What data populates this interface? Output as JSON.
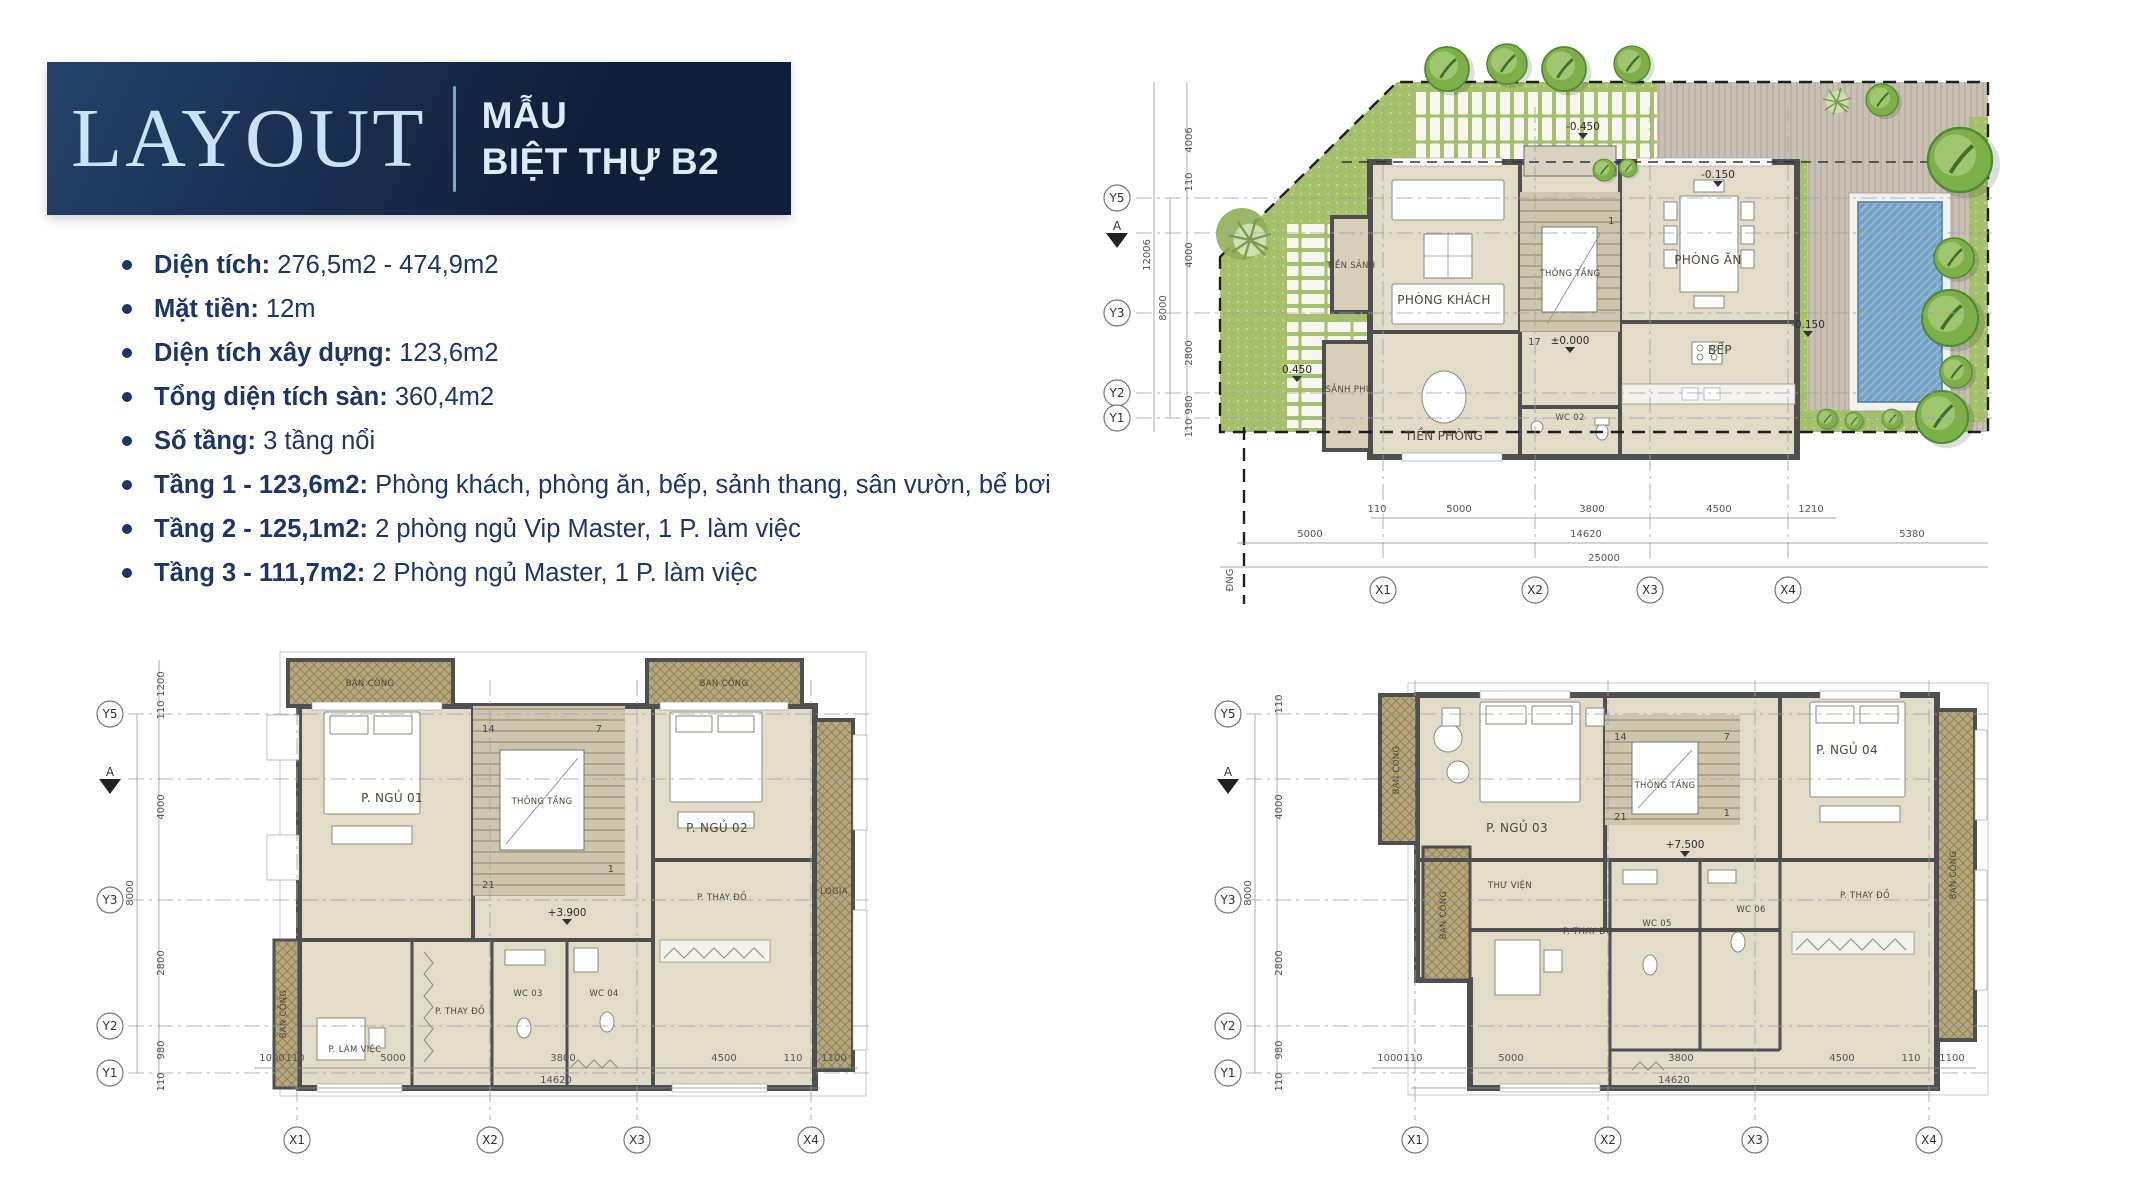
{
  "header": {
    "title": "LAYOUT",
    "subtitle_line1": "MẪU",
    "subtitle_line2": "BIỆT THỰ B2"
  },
  "specs": [
    {
      "label": "Diện tích:",
      "value": "276,5m2 - 474,9m2"
    },
    {
      "label": "Mặt tiền:",
      "value": "12m"
    },
    {
      "label": "Diện tích xây dựng:",
      "value": "123,6m2"
    },
    {
      "label": "Tổng diện tích sàn:",
      "value": "360,4m2"
    },
    {
      "label": "Số tầng:",
      "value": "3 tầng nổi"
    },
    {
      "label": "Tầng 1 - 123,6m2:",
      "value": "Phòng khách, phòng ăn, bếp, sảnh thang, sân vườn, bể bơi"
    },
    {
      "label": "Tầng 2 - 125,1m2:",
      "value": "2 phòng ngủ Vip Master, 1 P. làm việc"
    },
    {
      "label": "Tầng 3 - 111,7m2:",
      "value": "2 Phòng ngủ Master, 1 P. làm việc"
    }
  ],
  "site_plan": {
    "rooms": {
      "tien_sanh": "TIỀN SẢNH",
      "phong_khach": "PHÒNG KHÁCH",
      "thong_tang": "THÔNG TẦNG",
      "phong_an": "PHÒNG ĂN",
      "bep": "BẾP",
      "wc02": "WC 02",
      "tien_phong": "TIỀN PHÒNG",
      "sanh_phu": "SẢNH PHỤ"
    },
    "elevations": [
      "-0.450",
      "-0.150",
      "±0.000",
      "-0.150",
      "0.450"
    ],
    "stairs": [
      "17",
      "1"
    ],
    "axes_y": [
      "Y5",
      "A",
      "Y3",
      "Y2",
      "Y1"
    ],
    "axes_x": [
      "X1",
      "X2",
      "X3",
      "X4"
    ],
    "dims_left_chain": [
      "4006",
      "110",
      "4000",
      "2800",
      "980",
      "110"
    ],
    "dims_left_totals": [
      "8000",
      "12006"
    ],
    "dims_bottom_row1": [
      "110",
      "5000",
      "3800",
      "4500",
      "1210"
    ],
    "dims_bottom_row2": [
      "5000",
      "14620",
      "5380"
    ],
    "dims_bottom_total": "25000",
    "road_label": "ĐNG"
  },
  "floor2_plan": {
    "rooms": {
      "ban_cong_tl": "BAN CÔNG",
      "ban_cong_tr": "BAN CÔNG",
      "ban_cong_left": "BAN CÔNG",
      "p_ngu_01": "P. NGỦ 01",
      "p_ngu_02": "P. NGỦ 02",
      "thong_tang": "THÔNG TẦNG",
      "logia": "LOGIA",
      "p_lam_viec": "P. LÀM VIỆC",
      "p_thay_do_1": "P. THAY ĐỒ",
      "p_thay_do_2": "P. THAY ĐỒ",
      "wc03": "WC 03",
      "wc04": "WC 04"
    },
    "elev": "+3.900",
    "stairs": [
      "14",
      "7",
      "21",
      "1"
    ],
    "axes_y": [
      "Y5",
      "A",
      "Y3",
      "Y2",
      "Y1"
    ],
    "axes_x": [
      "X1",
      "X2",
      "X3",
      "X4"
    ],
    "dims_left_chain": [
      "1200",
      "110",
      "4000",
      "2800",
      "980",
      "110"
    ],
    "dims_left_total": "8000",
    "dims_bottom_row1": [
      "1000",
      "110",
      "5000",
      "3800",
      "4500",
      "110",
      "1100"
    ],
    "dims_bottom_total": "14620"
  },
  "floor3_plan": {
    "rooms": {
      "ban_cong_lt": "BAN CÔNG",
      "ban_cong_lb": "BAN CÔNG",
      "ban_cong_right": "BAN CÔNG",
      "p_ngu_03": "P. NGỦ 03",
      "p_ngu_04": "P. NGỦ 04",
      "thong_tang": "THÔNG TẦNG",
      "thu_vien": "THƯ VIỆN",
      "p_thay_do_1": "P. THAY ĐỒ",
      "p_thay_do_2": "P. THAY ĐỒ",
      "wc05": "WC 05",
      "wc06": "WC 06"
    },
    "elev": "+7.500",
    "stairs": [
      "14",
      "7",
      "21",
      "1"
    ],
    "axes_y": [
      "Y5",
      "A",
      "Y3",
      "Y2",
      "Y1"
    ],
    "axes_x": [
      "X1",
      "X2",
      "X3",
      "X4"
    ],
    "dims_left_chain": [
      "110",
      "4000",
      "2800",
      "980",
      "110"
    ],
    "dims_left_total": "8000",
    "dims_bottom_row1": [
      "1000",
      "110",
      "5000",
      "3800",
      "4500",
      "110",
      "1100"
    ],
    "dims_bottom_total": "14620"
  },
  "colors": {
    "header_bg1": "#24416a",
    "header_bg2": "#101f38",
    "header_title": "#c8e2f6",
    "header_sub": "#dcecfb",
    "divider": "#7fa8cc",
    "text_navy": "#1c3667",
    "wall": "#4f4f4f",
    "floor": "#e2dbc8",
    "floor_dark": "#cfc5ad",
    "balcony": "#b5a67c",
    "grass": "#a6c16b",
    "terrace": "#c9c0b4",
    "pool": "#7aa6c8",
    "tree": "#7eb049"
  }
}
